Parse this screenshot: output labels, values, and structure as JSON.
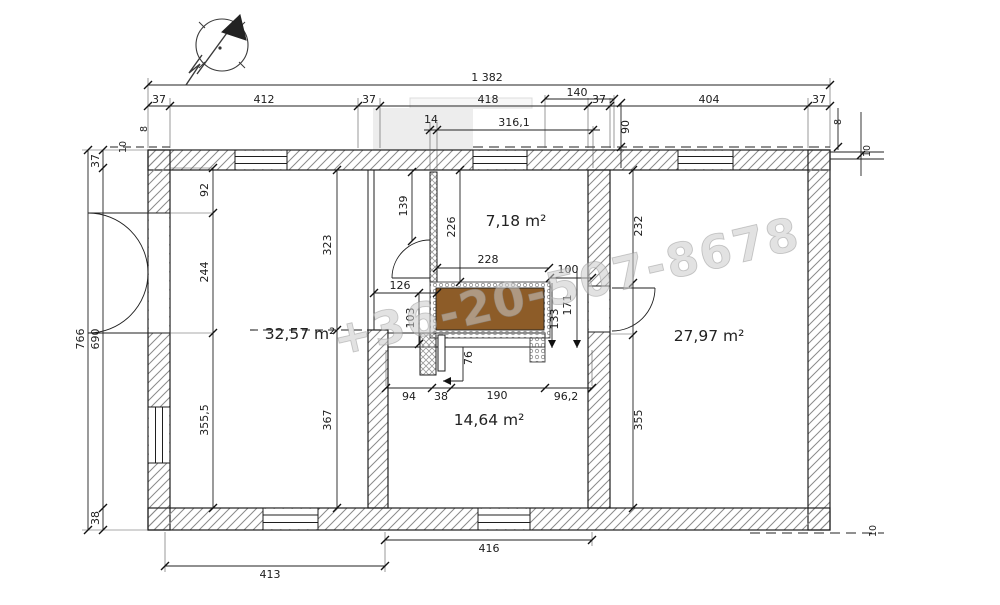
{
  "watermark": {
    "text": "+36-20-507-8678"
  },
  "rooms": {
    "living": "32,57 m²",
    "hall_top": "7,18 m²",
    "right": "27,97 m²",
    "bottom": "14,64 m²"
  },
  "dims": {
    "d1382": "1 382",
    "d37": "37",
    "d412": "412",
    "d418": "418",
    "d140": "140",
    "d404": "404",
    "d14": "14",
    "d316_1": "316,1",
    "d90": "90",
    "d8": "8",
    "d10": "10",
    "d766": "766",
    "d690": "690",
    "d92": "92",
    "d244": "244",
    "d355_5": "355,5",
    "d38": "38",
    "d323": "323",
    "d367": "367",
    "d139": "139",
    "d226": "226",
    "d232": "232",
    "d355": "355",
    "d228": "228",
    "d126": "126",
    "d103": "103",
    "d100": "100",
    "d171": "171",
    "d133": "133",
    "d76": "76",
    "d94": "94",
    "d190": "190",
    "d96_2": "96,2",
    "d416": "416",
    "d413": "413"
  }
}
